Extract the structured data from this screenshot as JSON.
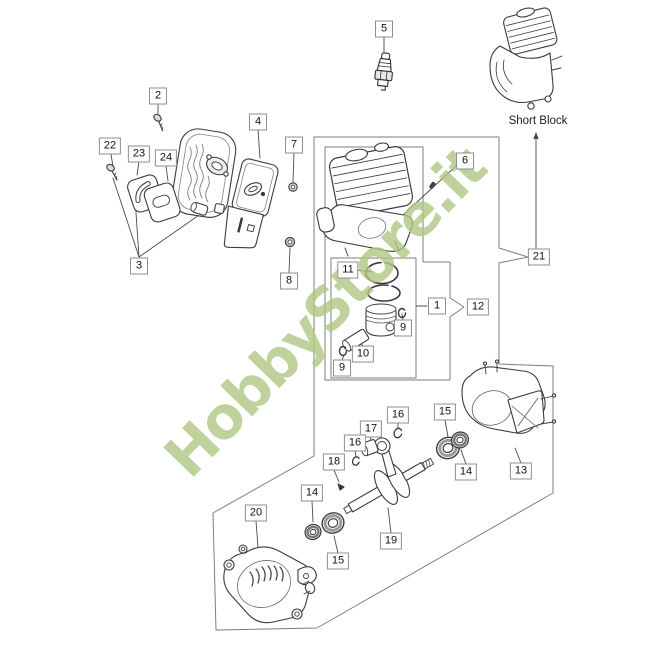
{
  "watermark": {
    "text": "HobbyStore.it",
    "color": "#b0c784"
  },
  "short_block": {
    "label": "Short Block"
  },
  "diagram": {
    "line_color": "#4a4a4a",
    "box_color": "#7d7d7d"
  },
  "callouts": [
    {
      "label": "2",
      "x": 158,
      "y": 96
    },
    {
      "label": "4",
      "x": 258,
      "y": 122
    },
    {
      "label": "22",
      "x": 110,
      "y": 146
    },
    {
      "label": "23",
      "x": 139,
      "y": 154
    },
    {
      "label": "24",
      "x": 166,
      "y": 158
    },
    {
      "label": "3",
      "x": 139,
      "y": 266
    },
    {
      "label": "7",
      "x": 294,
      "y": 145
    },
    {
      "label": "8",
      "x": 289,
      "y": 281
    },
    {
      "label": "5",
      "x": 384,
      "y": 29
    },
    {
      "label": "6",
      "x": 465,
      "y": 161
    },
    {
      "label": "21",
      "x": 539,
      "y": 257
    },
    {
      "label": "11",
      "x": 348,
      "y": 270
    },
    {
      "label": "1",
      "x": 437,
      "y": 306
    },
    {
      "label": "12",
      "x": 478,
      "y": 307
    },
    {
      "label": "9",
      "x": 403,
      "y": 328
    },
    {
      "label": "10",
      "x": 363,
      "y": 354
    },
    {
      "label": "9",
      "x": 342,
      "y": 368
    },
    {
      "label": "16",
      "x": 398,
      "y": 415
    },
    {
      "label": "15",
      "x": 445,
      "y": 412
    },
    {
      "label": "17",
      "x": 371,
      "y": 429
    },
    {
      "label": "16",
      "x": 355,
      "y": 443
    },
    {
      "label": "18",
      "x": 334,
      "y": 462
    },
    {
      "label": "14",
      "x": 466,
      "y": 472
    },
    {
      "label": "13",
      "x": 521,
      "y": 471
    },
    {
      "label": "14",
      "x": 312,
      "y": 493
    },
    {
      "label": "20",
      "x": 256,
      "y": 513
    },
    {
      "label": "19",
      "x": 391,
      "y": 541
    },
    {
      "label": "15",
      "x": 338,
      "y": 561
    }
  ],
  "connectors": [
    [
      158,
      105,
      158,
      115
    ],
    [
      111,
      154,
      113,
      167
    ],
    [
      139,
      161,
      137,
      175
    ],
    [
      166,
      166,
      168,
      181
    ],
    [
      258,
      130,
      260,
      158
    ],
    [
      294,
      153,
      293,
      182
    ],
    [
      289,
      273,
      290,
      248
    ],
    [
      384,
      38,
      384,
      52
    ],
    [
      456,
      166,
      404,
      214
    ],
    [
      139,
      257,
      113,
      178
    ],
    [
      139,
      257,
      135,
      198
    ],
    [
      139,
      257,
      202,
      213
    ],
    [
      416,
      306,
      427,
      306
    ],
    [
      357,
      270,
      373,
      272
    ],
    [
      403,
      320,
      402,
      314
    ],
    [
      363,
      346,
      359,
      340
    ],
    [
      342,
      360,
      344,
      355
    ],
    [
      398,
      423,
      398,
      429
    ],
    [
      445,
      420,
      448,
      437
    ],
    [
      371,
      437,
      370,
      442
    ],
    [
      355,
      450,
      356,
      457
    ],
    [
      334,
      470,
      339,
      482
    ],
    [
      466,
      464,
      461,
      450
    ],
    [
      521,
      463,
      515,
      448
    ],
    [
      312,
      501,
      313,
      522
    ],
    [
      256,
      521,
      258,
      548
    ],
    [
      391,
      533,
      388,
      508
    ],
    [
      338,
      553,
      334,
      536
    ],
    [
      536,
      134,
      536,
      248
    ]
  ]
}
